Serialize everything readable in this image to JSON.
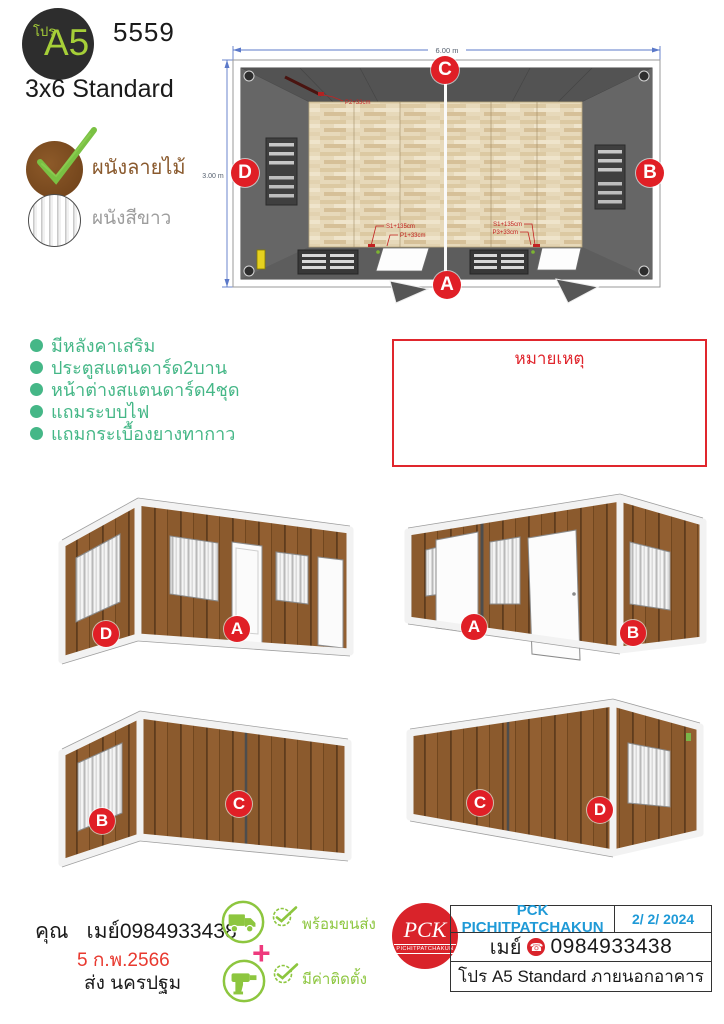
{
  "header": {
    "pro": "โปร",
    "model": "A5",
    "code": "5559",
    "size": "3x6 Standard"
  },
  "materials": [
    {
      "label": "ผนังลายไม้",
      "selected": true
    },
    {
      "label": "ผนังสีขาว",
      "selected": false
    }
  ],
  "plan": {
    "dim_width": "6.00 m",
    "dim_height": "3.00 m",
    "labels": {
      "top": "C",
      "bottom": "A",
      "left": "D",
      "right": "B"
    },
    "annotations": {
      "p2": "P2+33cm",
      "s1a": "S1+135cm",
      "p1": "P1+33cm",
      "s1b": "S1+135cm",
      "p3": "P3+33cm"
    }
  },
  "features": [
    "มีหลังคาเสริม",
    "ประตูสแตนดาร์ด2บาน",
    "หน้าต่างสแตนดาร์ด4ชุด",
    "แถมระบบไฟ",
    "แถมกระเบื้องยางทากาว"
  ],
  "note": {
    "title": "หมายเหตุ"
  },
  "views": [
    {
      "labels": [
        "D",
        "A"
      ]
    },
    {
      "labels": [
        "A",
        "B"
      ]
    },
    {
      "labels": [
        "B",
        "C"
      ]
    },
    {
      "labels": [
        "C",
        "D"
      ]
    }
  ],
  "contact": {
    "honorific": "คุณ",
    "name": "เมย์0984933438",
    "date": "5 ก.พ.2566",
    "delivery": "ส่ง นครปฐม"
  },
  "services": {
    "s1": "พร้อมขนส่ง",
    "s2": "มีค่าติดตั้ง",
    "plus": "+"
  },
  "company": {
    "name": "PCK PICHITPATCHAKUN",
    "date": "2/ 2/ 2024",
    "contact": "เมย์",
    "phone": "0984933438",
    "phone_glyph": "☎",
    "product": "โปร A5 Standard ภายนอกอาคาร",
    "logo_monogram": "PCK",
    "logo_band": "PICHITPATCHAKUN"
  },
  "colors": {
    "accent_green": "#45b787",
    "lime": "#8dc63f",
    "red": "#e01f26",
    "blue": "#1f9ad7",
    "dim_blue": "#5b79c9",
    "pink": "#ee3a7d",
    "brown": "#8a5a2e",
    "logo_green": "#a6cf38"
  }
}
